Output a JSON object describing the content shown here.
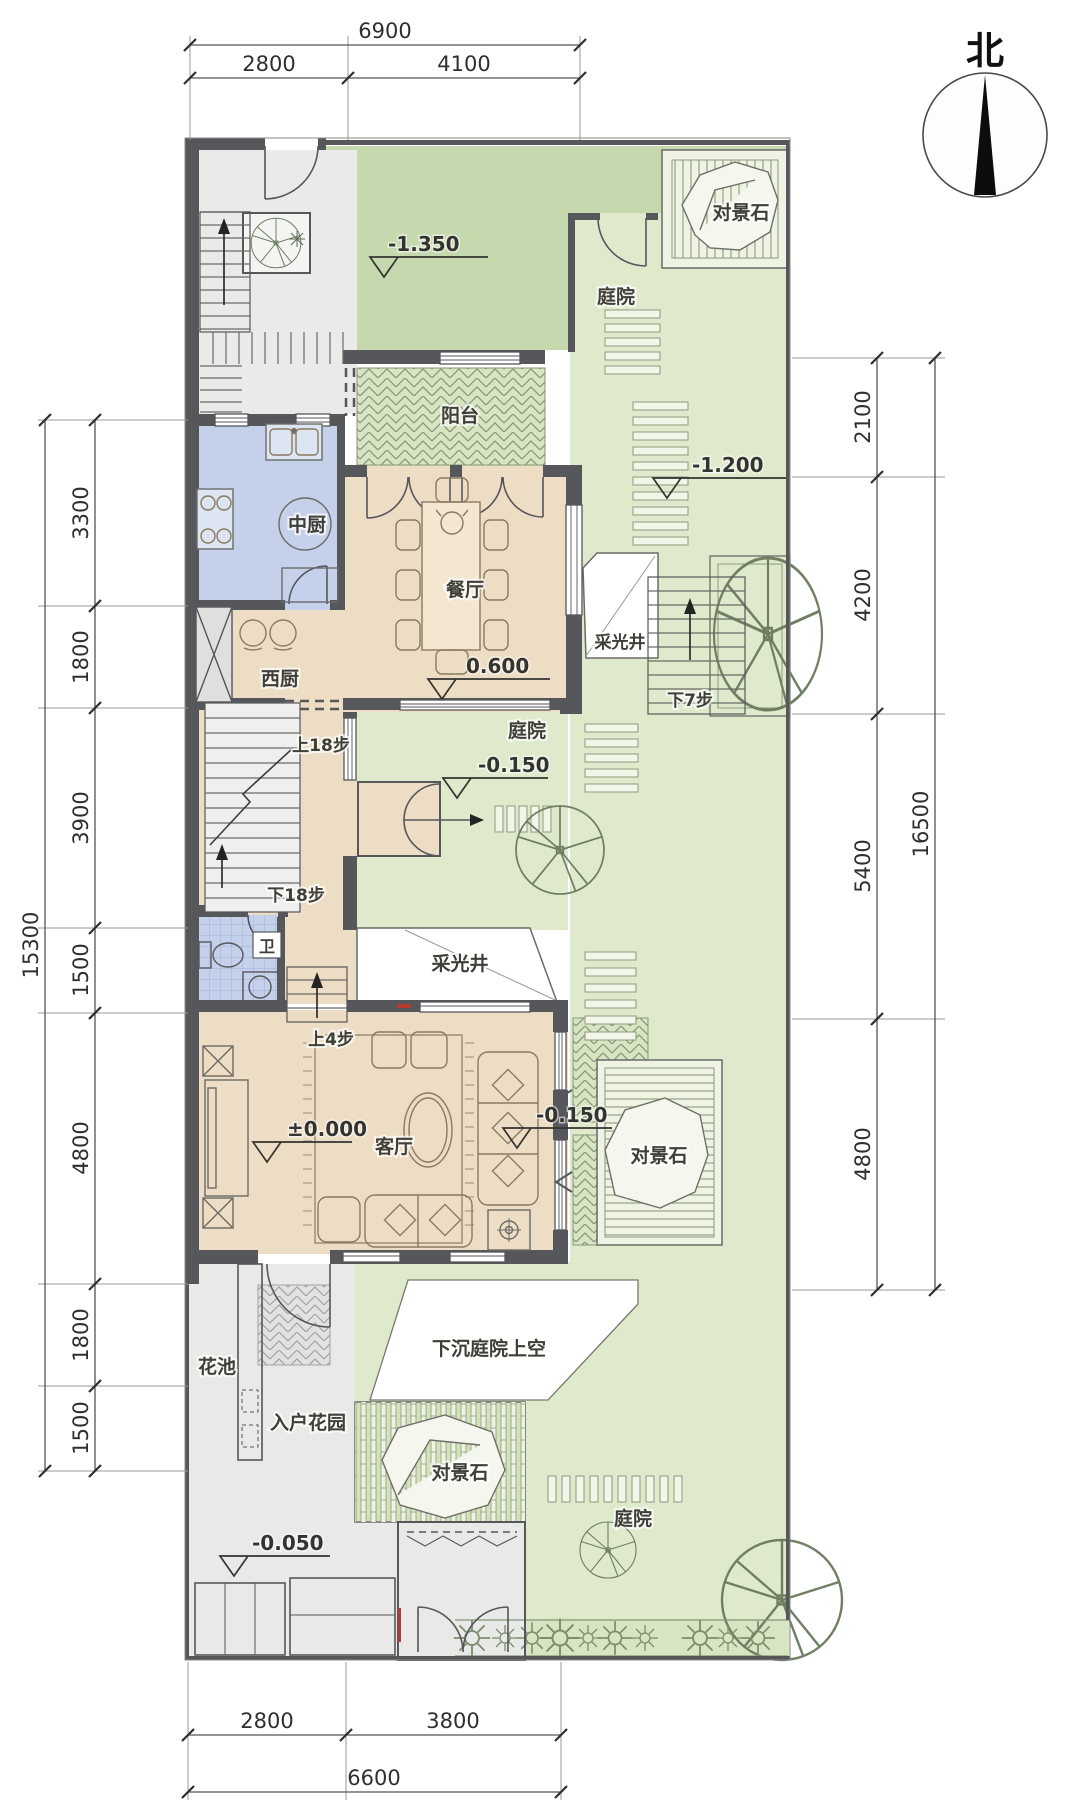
{
  "palette": {
    "wall": "#56575b",
    "room_tan": "#ecddc4",
    "room_blue": "#c5d1ea",
    "green_dark": "#c6d8ae",
    "green_light": "#dfeacd",
    "gray_circulation": "#eaeae8"
  },
  "compass": {
    "north": "北"
  },
  "labels": {
    "balcony": "阳台",
    "kitchen_cn": "中厨",
    "kitchen_west": "西厨",
    "dining": "餐厅",
    "bath": "卫",
    "living": "客厅",
    "flower_bed": "花池",
    "entry_garden": "入户花园",
    "sunken_courtyard": "下沉庭院上空",
    "courtyard_top": "庭院",
    "courtyard_mid": "庭院",
    "courtyard_bottom": "庭院",
    "stone_top": "对景石",
    "stone_mid": "对景石",
    "stone_bottom": "对景石",
    "lightwell_east": "采光井",
    "lightwell_mid": "采光井",
    "stair_up18": "上18步",
    "stair_down18": "下18步",
    "stair_down7": "下7步",
    "stair_up4": "上4步"
  },
  "elevations": {
    "top_courtyard": "-1.350",
    "east_courtyard": "-1.200",
    "dining": "0.600",
    "mid_courtyard": "-0.150",
    "living": "±0.000",
    "south_courtyard": "-0.150",
    "entrance": "-0.050"
  },
  "dimensions": {
    "top": {
      "total": "6900",
      "seg1": "2800",
      "seg2": "4100"
    },
    "bottom": {
      "total": "6600",
      "seg1": "2800",
      "seg2": "3800"
    },
    "left": {
      "total": "15300",
      "segs": [
        "3300",
        "1800",
        "3900",
        "1500",
        "4800",
        "1800",
        "1500"
      ]
    },
    "right": {
      "total": "16500",
      "segs": [
        "2100",
        "4200",
        "5400",
        "4800"
      ]
    }
  }
}
